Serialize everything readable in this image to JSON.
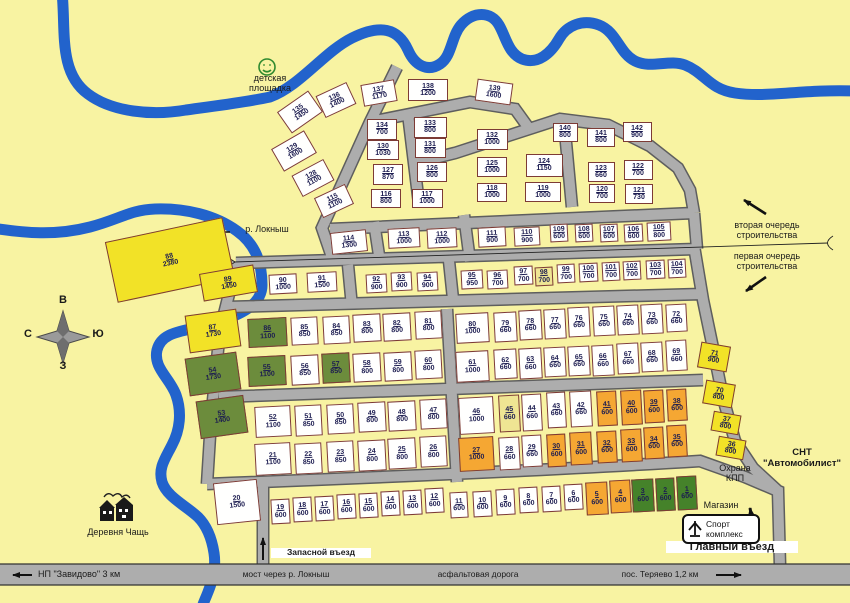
{
  "map_title": "План СНТ \"Автомобилист\"",
  "colors": {
    "bg": "#F8F3A2",
    "river": "#2263CC",
    "road": "#ADADAD",
    "road_edge": "#5E5E5E",
    "plot_white": "#FFFFFE",
    "plot_yellow": "#F2E227",
    "plot_green": "#6C8C3C",
    "plot_darkgreen": "#45822A",
    "plot_orange": "#F5A733",
    "plot_cream": "#EFE593",
    "pborder": "#7D3B35",
    "ptext": "#1C1C50",
    "ltext": "#1A1A1A"
  },
  "sport": {
    "line1": "Спорт",
    "line2": "комплекс"
  },
  "labels": [
    {
      "id": "playground-label",
      "x": 228,
      "y": 73,
      "w": 84,
      "s": 9,
      "lines": [
        "детская",
        "площадка"
      ]
    },
    {
      "id": "river-label",
      "x": 234,
      "y": 224,
      "w": 66,
      "s": 9,
      "lines": [
        "р. Локныш"
      ]
    },
    {
      "id": "phase2-label",
      "x": 714,
      "y": 220,
      "w": 106,
      "s": 9,
      "lines": [
        "вторая очередь",
        "строительства"
      ]
    },
    {
      "id": "phase1-label",
      "x": 714,
      "y": 251,
      "w": 106,
      "s": 9,
      "lines": [
        "первая очередь",
        "строительства"
      ]
    },
    {
      "id": "snt-name-label",
      "x": 754,
      "y": 448,
      "w": 96,
      "s": 9.5,
      "bold": 1,
      "lines": [
        "СНТ",
        "\"Автомобилист\""
      ]
    },
    {
      "id": "guard-checkpoint-label",
      "x": 706,
      "y": 463,
      "w": 58,
      "s": 9,
      "lines": [
        "Охрана",
        "КПП"
      ]
    },
    {
      "id": "shop-label",
      "x": 694,
      "y": 500,
      "w": 54,
      "s": 9,
      "lines": [
        "Магазин"
      ]
    },
    {
      "id": "main-entrance-label",
      "x": 666,
      "y": 541,
      "w": 126,
      "s": 11,
      "bold": 1,
      "bg": 1,
      "lines": [
        "Главный въезд"
      ]
    },
    {
      "id": "reserve-entrance-label",
      "x": 271,
      "y": 548,
      "w": 94,
      "s": 8.5,
      "bold": 1,
      "bg": 1,
      "lines": [
        "Запасной въезд"
      ]
    },
    {
      "id": "village-label",
      "x": 70,
      "y": 527,
      "w": 96,
      "s": 9,
      "lines": [
        "Деревня Чащь"
      ]
    },
    {
      "id": "road-zavidovo-label",
      "x": 38,
      "y": 569,
      "w": 112,
      "s": 9,
      "left": 1,
      "lines": [
        "НП \"Завидово\" 3 км"
      ]
    },
    {
      "id": "road-bridge-label",
      "x": 226,
      "y": 570,
      "w": 120,
      "s": 8.5,
      "lines": [
        "мост через р. Локныш"
      ]
    },
    {
      "id": "road-asphalt-label",
      "x": 426,
      "y": 570,
      "w": 104,
      "s": 8.5,
      "lines": [
        "асфальтовая дорога"
      ]
    },
    {
      "id": "road-teryaevo-label",
      "x": 606,
      "y": 570,
      "w": 108,
      "s": 8.5,
      "lines": [
        "пос. Теряево 1,2 км"
      ]
    },
    {
      "id": "compass-letter-top",
      "x": 56,
      "y": 294,
      "w": 14,
      "s": 11,
      "bold": 1,
      "lines": [
        "В"
      ]
    },
    {
      "id": "compass-letter-right",
      "x": 91,
      "y": 328,
      "w": 14,
      "s": 11,
      "bold": 1,
      "lines": [
        "Ю"
      ]
    },
    {
      "id": "compass-letter-left",
      "x": 21,
      "y": 328,
      "w": 14,
      "s": 11,
      "bold": 1,
      "lines": [
        "С"
      ]
    },
    {
      "id": "compass-letter-bottom",
      "x": 56,
      "y": 360,
      "w": 14,
      "s": 11,
      "bold": 1,
      "lines": [
        "З"
      ]
    }
  ],
  "plots": [
    [
      1,
      600,
      687,
      493,
      20,
      34,
      "g2",
      -3
    ],
    [
      2,
      600,
      665,
      494,
      19,
      33,
      "g2",
      -3
    ],
    [
      3,
      600,
      643,
      495,
      22,
      33,
      "g2",
      -3
    ],
    [
      4,
      600,
      620,
      496,
      21,
      33,
      "o",
      -3
    ],
    [
      5,
      600,
      597,
      498,
      22,
      33,
      "o",
      -3
    ],
    [
      6,
      600,
      573,
      497,
      19,
      26,
      "w",
      -3
    ],
    [
      7,
      600,
      551,
      499,
      19,
      26,
      "w",
      -3
    ],
    [
      8,
      600,
      528,
      500,
      19,
      26,
      "w",
      -3
    ],
    [
      9,
      600,
      505,
      502,
      19,
      26,
      "w",
      -3
    ],
    [
      10,
      600,
      482,
      504,
      19,
      26,
      "w",
      -3
    ],
    [
      11,
      600,
      459,
      505,
      18,
      26,
      "w",
      -3
    ],
    [
      12,
      600,
      434,
      500,
      19,
      25,
      "w",
      -3
    ],
    [
      13,
      600,
      412,
      502,
      19,
      25,
      "w",
      -3
    ],
    [
      14,
      600,
      390,
      503,
      19,
      25,
      "w",
      -3
    ],
    [
      15,
      600,
      368,
      505,
      19,
      25,
      "w",
      -3
    ],
    [
      16,
      600,
      346,
      506,
      19,
      25,
      "w",
      -3
    ],
    [
      17,
      600,
      324,
      508,
      19,
      25,
      "w",
      -3
    ],
    [
      18,
      600,
      302,
      509,
      19,
      25,
      "w",
      -3
    ],
    [
      19,
      600,
      280,
      511,
      19,
      25,
      "w",
      -3
    ],
    [
      20,
      1500,
      237,
      502,
      44,
      42,
      "w",
      -6
    ],
    [
      21,
      1100,
      273,
      459,
      36,
      32,
      "w",
      -3
    ],
    [
      22,
      850,
      308,
      458,
      27,
      31,
      "w",
      -3
    ],
    [
      23,
      850,
      340,
      456,
      27,
      31,
      "w",
      -3
    ],
    [
      24,
      800,
      372,
      455,
      28,
      31,
      "w",
      -3
    ],
    [
      25,
      800,
      402,
      453,
      28,
      31,
      "w",
      -3
    ],
    [
      26,
      800,
      433,
      451,
      27,
      31,
      "w",
      -3
    ],
    [
      27,
      1000,
      476,
      454,
      35,
      34,
      "o",
      -3
    ],
    [
      28,
      660,
      509,
      453,
      21,
      33,
      "w",
      -3
    ],
    [
      29,
      660,
      532,
      451,
      20,
      32,
      "w",
      -3
    ],
    [
      30,
      600,
      556,
      450,
      19,
      33,
      "o",
      -3
    ],
    [
      31,
      600,
      581,
      448,
      22,
      33,
      "o",
      -3
    ],
    [
      32,
      600,
      607,
      447,
      20,
      32,
      "o",
      -3
    ],
    [
      33,
      600,
      631,
      445,
      21,
      33,
      "o",
      -3
    ],
    [
      34,
      600,
      654,
      443,
      20,
      32,
      "o",
      -3
    ],
    [
      35,
      600,
      677,
      441,
      20,
      32,
      "o",
      -3
    ],
    [
      36,
      800,
      731,
      448,
      28,
      20,
      "y",
      10
    ],
    [
      37,
      800,
      726,
      423,
      28,
      20,
      "y",
      10
    ],
    [
      38,
      600,
      677,
      405,
      20,
      32,
      "o",
      -3
    ],
    [
      39,
      600,
      654,
      406,
      20,
      33,
      "o",
      -3
    ],
    [
      40,
      600,
      631,
      407,
      21,
      35,
      "o",
      -3
    ],
    [
      41,
      600,
      607,
      408,
      20,
      35,
      "o",
      -3
    ],
    [
      42,
      660,
      581,
      409,
      22,
      36,
      "w",
      -3
    ],
    [
      43,
      660,
      556,
      410,
      19,
      36,
      "w",
      -3
    ],
    [
      44,
      660,
      532,
      412,
      20,
      37,
      "w",
      -3
    ],
    [
      45,
      660,
      509,
      413,
      21,
      37,
      "c",
      -3
    ],
    [
      46,
      1000,
      476,
      415,
      35,
      37,
      "w",
      -3
    ],
    [
      47,
      800,
      433,
      414,
      27,
      30,
      "w",
      -3
    ],
    [
      48,
      800,
      402,
      416,
      28,
      30,
      "w",
      -3
    ],
    [
      49,
      800,
      372,
      417,
      28,
      30,
      "w",
      -3
    ],
    [
      50,
      850,
      340,
      419,
      27,
      30,
      "w",
      -3
    ],
    [
      51,
      850,
      308,
      420,
      27,
      31,
      "w",
      -3
    ],
    [
      52,
      1100,
      273,
      421,
      36,
      31,
      "w",
      -3
    ],
    [
      53,
      1400,
      222,
      417,
      48,
      38,
      "g",
      -8
    ],
    [
      54,
      1730,
      213,
      374,
      52,
      38,
      "g",
      -8
    ],
    [
      55,
      1100,
      267,
      371,
      38,
      30,
      "g",
      -3
    ],
    [
      56,
      850,
      305,
      370,
      28,
      30,
      "w",
      -3
    ],
    [
      57,
      850,
      336,
      368,
      28,
      30,
      "g",
      -3
    ],
    [
      58,
      800,
      367,
      367,
      28,
      29,
      "w",
      -3
    ],
    [
      59,
      800,
      398,
      366,
      28,
      29,
      "w",
      -3
    ],
    [
      60,
      800,
      428,
      364,
      27,
      29,
      "w",
      -3
    ],
    [
      61,
      1000,
      472,
      366,
      33,
      31,
      "w",
      -3
    ],
    [
      62,
      660,
      505,
      364,
      23,
      30,
      "w",
      -3
    ],
    [
      63,
      660,
      530,
      363,
      23,
      31,
      "w",
      -3
    ],
    [
      64,
      660,
      555,
      362,
      22,
      30,
      "w",
      -3
    ],
    [
      65,
      660,
      579,
      361,
      22,
      30,
      "w",
      -3
    ],
    [
      66,
      660,
      603,
      360,
      22,
      31,
      "w",
      -3
    ],
    [
      67,
      660,
      628,
      358,
      22,
      31,
      "w",
      -3
    ],
    [
      68,
      660,
      652,
      357,
      22,
      30,
      "w",
      -3
    ],
    [
      69,
      660,
      676,
      355,
      21,
      31,
      "w",
      -3
    ],
    [
      70,
      800,
      719,
      394,
      30,
      24,
      "y",
      10
    ],
    [
      71,
      900,
      714,
      357,
      30,
      26,
      "y",
      10
    ],
    [
      72,
      660,
      676,
      318,
      21,
      28,
      "w",
      -3
    ],
    [
      73,
      660,
      652,
      319,
      22,
      30,
      "w",
      -3
    ],
    [
      74,
      660,
      628,
      320,
      22,
      30,
      "w",
      -3
    ],
    [
      75,
      660,
      604,
      321,
      22,
      30,
      "w",
      -3
    ],
    [
      76,
      660,
      579,
      322,
      22,
      30,
      "w",
      -3
    ],
    [
      77,
      660,
      555,
      324,
      22,
      30,
      "w",
      -3
    ],
    [
      78,
      660,
      530,
      325,
      23,
      30,
      "w",
      -3
    ],
    [
      79,
      660,
      505,
      327,
      23,
      30,
      "w",
      -3
    ],
    [
      80,
      1000,
      472,
      328,
      33,
      30,
      "w",
      -3
    ],
    [
      81,
      800,
      428,
      325,
      27,
      28,
      "w",
      -3
    ],
    [
      82,
      800,
      397,
      327,
      28,
      28,
      "w",
      -3
    ],
    [
      83,
      800,
      367,
      328,
      28,
      28,
      "w",
      -3
    ],
    [
      84,
      850,
      336,
      330,
      27,
      28,
      "w",
      -3
    ],
    [
      85,
      850,
      304,
      331,
      27,
      28,
      "w",
      -3
    ],
    [
      86,
      1100,
      267,
      332,
      39,
      29,
      "g",
      -3
    ],
    [
      87,
      1730,
      213,
      331,
      52,
      38,
      "y",
      -8
    ],
    [
      88,
      2380,
      170,
      260,
      120,
      62,
      "y",
      -12
    ],
    [
      89,
      1450,
      228,
      283,
      55,
      28,
      "y",
      -10
    ],
    [
      90,
      1000,
      283,
      284,
      28,
      20,
      "w",
      -3
    ],
    [
      91,
      1500,
      322,
      282,
      30,
      20,
      "w",
      -3
    ],
    [
      92,
      900,
      376,
      283,
      21,
      19,
      "w",
      -3
    ],
    [
      93,
      900,
      401,
      281,
      21,
      19,
      "w",
      -3
    ],
    [
      94,
      900,
      427,
      281,
      21,
      19,
      "w",
      -3
    ],
    [
      95,
      950,
      472,
      279,
      22,
      19,
      "w",
      -3
    ],
    [
      96,
      700,
      497,
      279,
      21,
      19,
      "w",
      -3
    ],
    [
      97,
      700,
      523,
      275,
      19,
      19,
      "w",
      -3
    ],
    [
      98,
      700,
      544,
      276,
      18,
      19,
      "c",
      -3
    ],
    [
      99,
      700,
      566,
      273,
      18,
      19,
      "w",
      -3
    ],
    [
      100,
      700,
      588,
      272,
      19,
      19,
      "w",
      -3
    ],
    [
      101,
      700,
      611,
      271,
      18,
      19,
      "w",
      -3
    ],
    [
      102,
      700,
      632,
      270,
      18,
      19,
      "w",
      -3
    ],
    [
      103,
      700,
      655,
      269,
      19,
      19,
      "w",
      -3
    ],
    [
      104,
      700,
      677,
      268,
      18,
      19,
      "w",
      -3
    ],
    [
      105,
      800,
      659,
      231,
      24,
      19,
      "w",
      -3
    ],
    [
      106,
      600,
      633,
      233,
      19,
      18,
      "w",
      -3
    ],
    [
      107,
      600,
      609,
      233,
      18,
      18,
      "w",
      -3
    ],
    [
      108,
      600,
      584,
      233,
      18,
      18,
      "w",
      -3
    ],
    [
      109,
      600,
      559,
      233,
      18,
      18,
      "w",
      -3
    ],
    [
      110,
      900,
      527,
      236,
      26,
      19,
      "w",
      -3
    ],
    [
      111,
      900,
      492,
      237,
      28,
      20,
      "w",
      -3
    ],
    [
      112,
      1000,
      442,
      238,
      30,
      20,
      "w",
      -3
    ],
    [
      113,
      1000,
      404,
      238,
      32,
      20,
      "w",
      -3
    ],
    [
      114,
      1300,
      349,
      242,
      36,
      22,
      "w",
      -6
    ],
    [
      115,
      1100,
      334,
      201,
      34,
      22,
      "w",
      -25
    ],
    [
      116,
      800,
      386,
      198,
      30,
      19,
      "w",
      0
    ],
    [
      117,
      1000,
      427,
      198,
      31,
      19,
      "w",
      0
    ],
    [
      118,
      1000,
      492,
      192,
      30,
      19,
      "w",
      0
    ],
    [
      119,
      1000,
      543,
      192,
      36,
      20,
      "w",
      0
    ],
    [
      120,
      700,
      602,
      193,
      26,
      19,
      "w",
      0
    ],
    [
      121,
      730,
      639,
      194,
      28,
      20,
      "w",
      0
    ],
    [
      122,
      700,
      638,
      170,
      29,
      20,
      "w",
      0
    ],
    [
      123,
      660,
      601,
      172,
      27,
      20,
      "w",
      0
    ],
    [
      124,
      1150,
      544,
      165,
      37,
      23,
      "w",
      0
    ],
    [
      125,
      1000,
      492,
      167,
      30,
      20,
      "w",
      0
    ],
    [
      126,
      800,
      432,
      172,
      30,
      20,
      "w",
      0
    ],
    [
      127,
      870,
      388,
      174,
      30,
      21,
      "w",
      0
    ],
    [
      128,
      1100,
      313,
      178,
      36,
      24,
      "w",
      -28
    ],
    [
      129,
      1600,
      294,
      151,
      38,
      26,
      "w",
      -30
    ],
    [
      130,
      1030,
      383,
      150,
      32,
      20,
      "w",
      0
    ],
    [
      131,
      800,
      430,
      148,
      31,
      20,
      "w",
      0
    ],
    [
      132,
      1000,
      492,
      139,
      31,
      21,
      "w",
      0
    ],
    [
      133,
      800,
      430,
      127,
      33,
      21,
      "w",
      0
    ],
    [
      134,
      700,
      382,
      129,
      30,
      21,
      "w",
      0
    ],
    [
      135,
      1450,
      300,
      112,
      38,
      26,
      "w",
      -35
    ],
    [
      136,
      1400,
      336,
      100,
      34,
      24,
      "w",
      -25
    ],
    [
      137,
      1170,
      379,
      93,
      34,
      22,
      "w",
      -10
    ],
    [
      138,
      1200,
      428,
      90,
      40,
      22,
      "w",
      0
    ],
    [
      139,
      1600,
      494,
      92,
      36,
      22,
      "w",
      8
    ],
    [
      140,
      800,
      565,
      132,
      25,
      19,
      "w",
      0
    ],
    [
      141,
      800,
      601,
      137,
      28,
      19,
      "w",
      0
    ],
    [
      142,
      900,
      637,
      132,
      29,
      20,
      "w",
      0
    ]
  ]
}
